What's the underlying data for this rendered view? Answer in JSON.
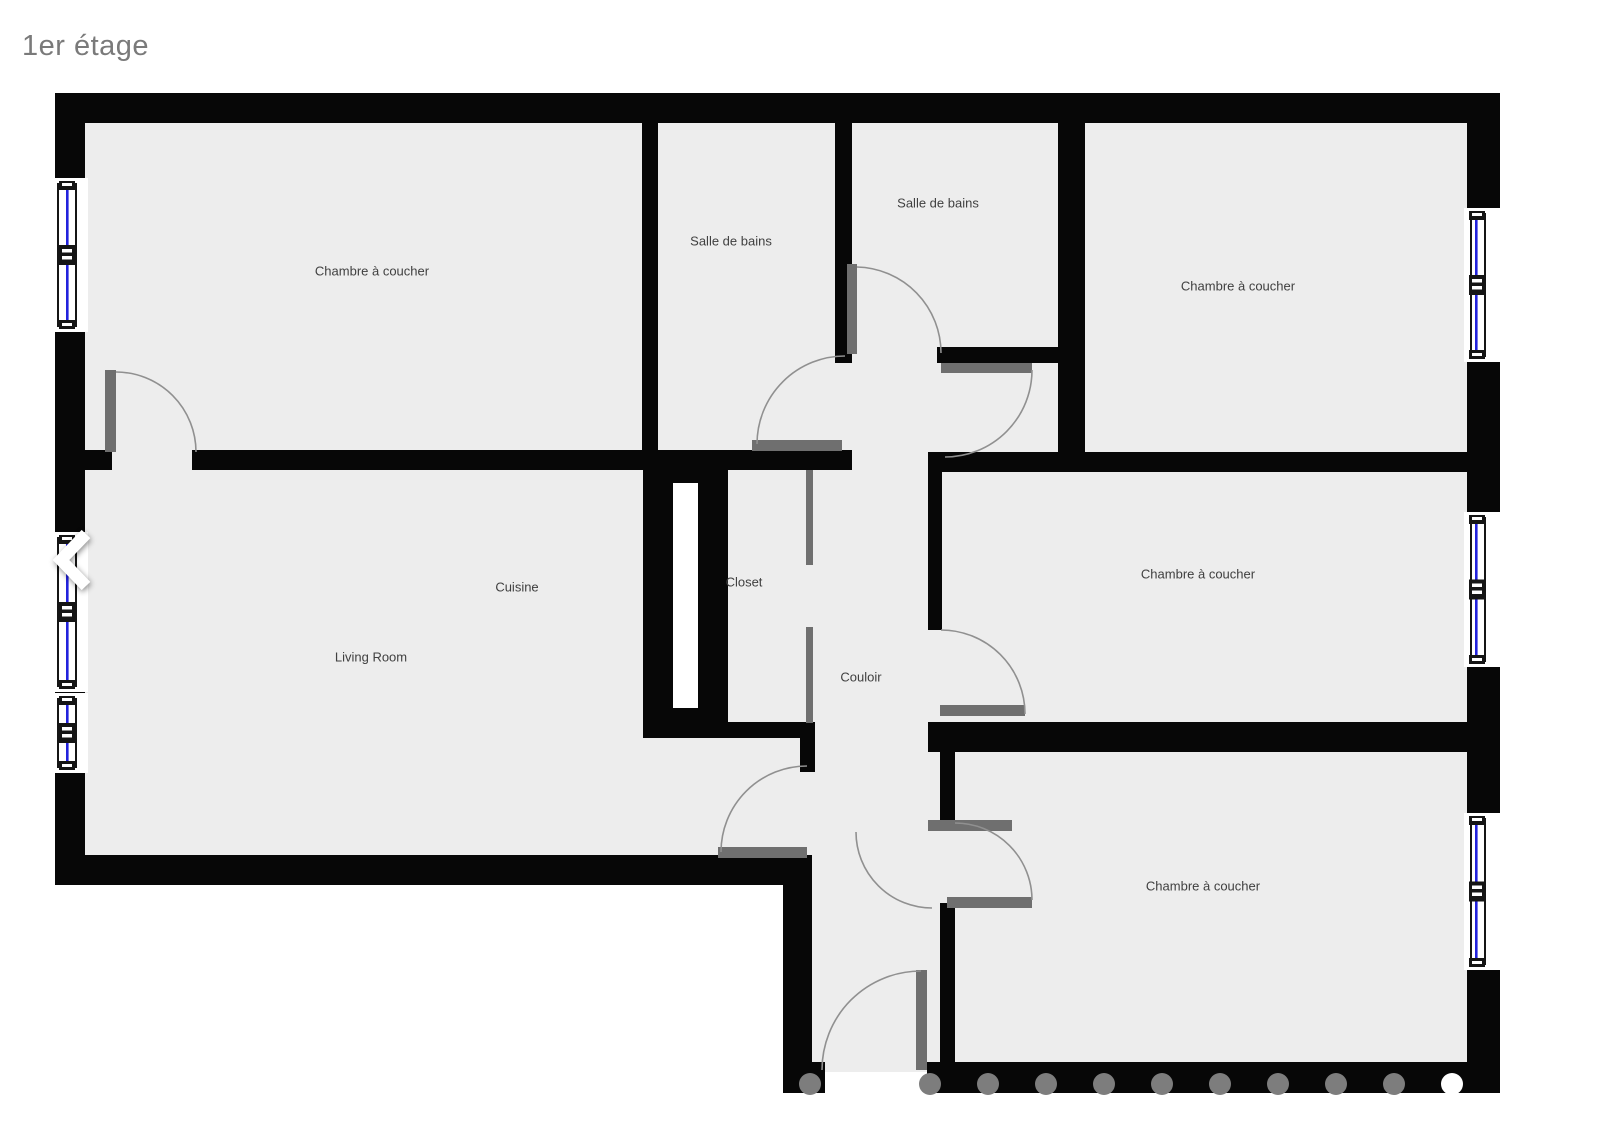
{
  "page": {
    "title": "1er étage"
  },
  "floorplan": {
    "colors": {
      "wall": "#070707",
      "room_fill": "#ededed",
      "door_leaf": "#6f6f6f",
      "swing_arc": "#909090",
      "window_glass": "#2222dd",
      "window_frame": "#151515",
      "label_text": "#404040"
    },
    "room_labels": [
      {
        "id": "bedroom-top-left",
        "label": "Chambre à coucher",
        "x": 372,
        "y": 272
      },
      {
        "id": "bathroom-left",
        "label": "Salle de bains",
        "x": 731,
        "y": 242
      },
      {
        "id": "bathroom-right",
        "label": "Salle de bains",
        "x": 938,
        "y": 204
      },
      {
        "id": "bedroom-top-right",
        "label": "Chambre à coucher",
        "x": 1238,
        "y": 287
      },
      {
        "id": "cuisine",
        "label": "Cuisine",
        "x": 517,
        "y": 588
      },
      {
        "id": "living-room",
        "label": "Living Room",
        "x": 371,
        "y": 658
      },
      {
        "id": "closet",
        "label": "Closet",
        "x": 744,
        "y": 583
      },
      {
        "id": "couloir",
        "label": "Couloir",
        "x": 861,
        "y": 678
      },
      {
        "id": "bedroom-middle-right",
        "label": "Chambre à coucher",
        "x": 1198,
        "y": 575
      },
      {
        "id": "bedroom-bottom-right",
        "label": "Chambre à coucher",
        "x": 1203,
        "y": 887
      }
    ],
    "geometry": {
      "floors": [
        [
          85,
          122,
          1382,
          733
        ],
        [
          812,
          855,
          655,
          207
        ],
        [
          825,
          1062,
          102,
          10
        ]
      ],
      "walls": [
        [
          55,
          93,
          1445,
          30
        ],
        [
          55,
          93,
          30,
          792
        ],
        [
          55,
          855,
          757,
          30
        ],
        [
          783,
          855,
          29,
          238
        ],
        [
          812,
          1062,
          13,
          31
        ],
        [
          927,
          1062,
          573,
          31
        ],
        [
          1467,
          93,
          33,
          1000
        ],
        [
          642,
          122,
          16,
          330
        ],
        [
          835,
          122,
          17,
          241
        ],
        [
          937,
          347,
          148,
          16
        ],
        [
          1058,
          122,
          27,
          330
        ],
        [
          85,
          450,
          27,
          20
        ],
        [
          192,
          450,
          660,
          20
        ],
        [
          643,
          452,
          85,
          286
        ],
        [
          728,
          722,
          87,
          16
        ],
        [
          800,
          722,
          15,
          50
        ],
        [
          928,
          452,
          14,
          178
        ],
        [
          928,
          722,
          572,
          30
        ],
        [
          938,
          452,
          562,
          20
        ],
        [
          940,
          752,
          15,
          75
        ],
        [
          940,
          903,
          15,
          159
        ]
      ],
      "white_slots": [
        [
          673,
          483,
          25,
          225
        ]
      ],
      "door_leaves": [
        [
          105,
          370,
          11,
          82
        ],
        [
          752,
          440,
          90,
          11
        ],
        [
          847,
          264,
          10,
          90
        ],
        [
          941,
          363,
          91,
          10
        ],
        [
          940,
          705,
          85,
          11
        ],
        [
          947,
          897,
          85,
          11
        ],
        [
          928,
          820,
          84,
          11
        ],
        [
          718,
          847,
          89,
          11
        ],
        [
          916,
          970,
          11,
          100
        ],
        [
          806,
          470,
          7,
          95
        ],
        [
          806,
          627,
          7,
          96
        ]
      ],
      "swing_arcs": [
        "M 116 372 A 80 80 0 0 1 196 452",
        "M 757 444 A 88 88 0 0 1 845 356",
        "M 857 267 A 86 86 0 0 1 941 353",
        "M 1032 370 A 87 87 0 0 1 945 457",
        "M 941 630 A 84 84 0 0 1 1025 714",
        "M 1032 900 A 77 77 0 0 0 955 823",
        "M 856 832 A 76 76 0 0 0 932 908",
        "M 807 766 A 86 86 0 0 0 721 852",
        "M 921 971 A 99 99 0 0 0 822 1070"
      ],
      "windows": [
        {
          "side": "left",
          "y1": 183,
          "y2": 327
        },
        {
          "side": "left",
          "y1": 537,
          "y2": 687
        },
        {
          "side": "left",
          "y1": 698,
          "y2": 768
        },
        {
          "side": "right",
          "y1": 213,
          "y2": 357
        },
        {
          "side": "right",
          "y1": 517,
          "y2": 662
        },
        {
          "side": "right",
          "y1": 818,
          "y2": 965
        }
      ],
      "window_styles": {
        "left": {
          "recess_x": 52,
          "recess_w": 36,
          "frame1": 57,
          "frame2": 75,
          "glass": 66,
          "cx": 67
        },
        "right": {
          "recess_x": 1464,
          "recess_w": 40,
          "frame1": 1470,
          "frame2": 1484,
          "glass": 1475,
          "cx": 1477
        }
      }
    }
  },
  "carousel": {
    "prev_icon": "chevron-left",
    "dots": {
      "y": 1084,
      "radius": 11,
      "gray_xs": [
        810,
        930,
        988,
        1046,
        1104,
        1162,
        1220,
        1278,
        1336,
        1394
      ],
      "active_x": 1452,
      "gray_color": "#7d7d7d",
      "active_color": "#ffffff"
    }
  }
}
